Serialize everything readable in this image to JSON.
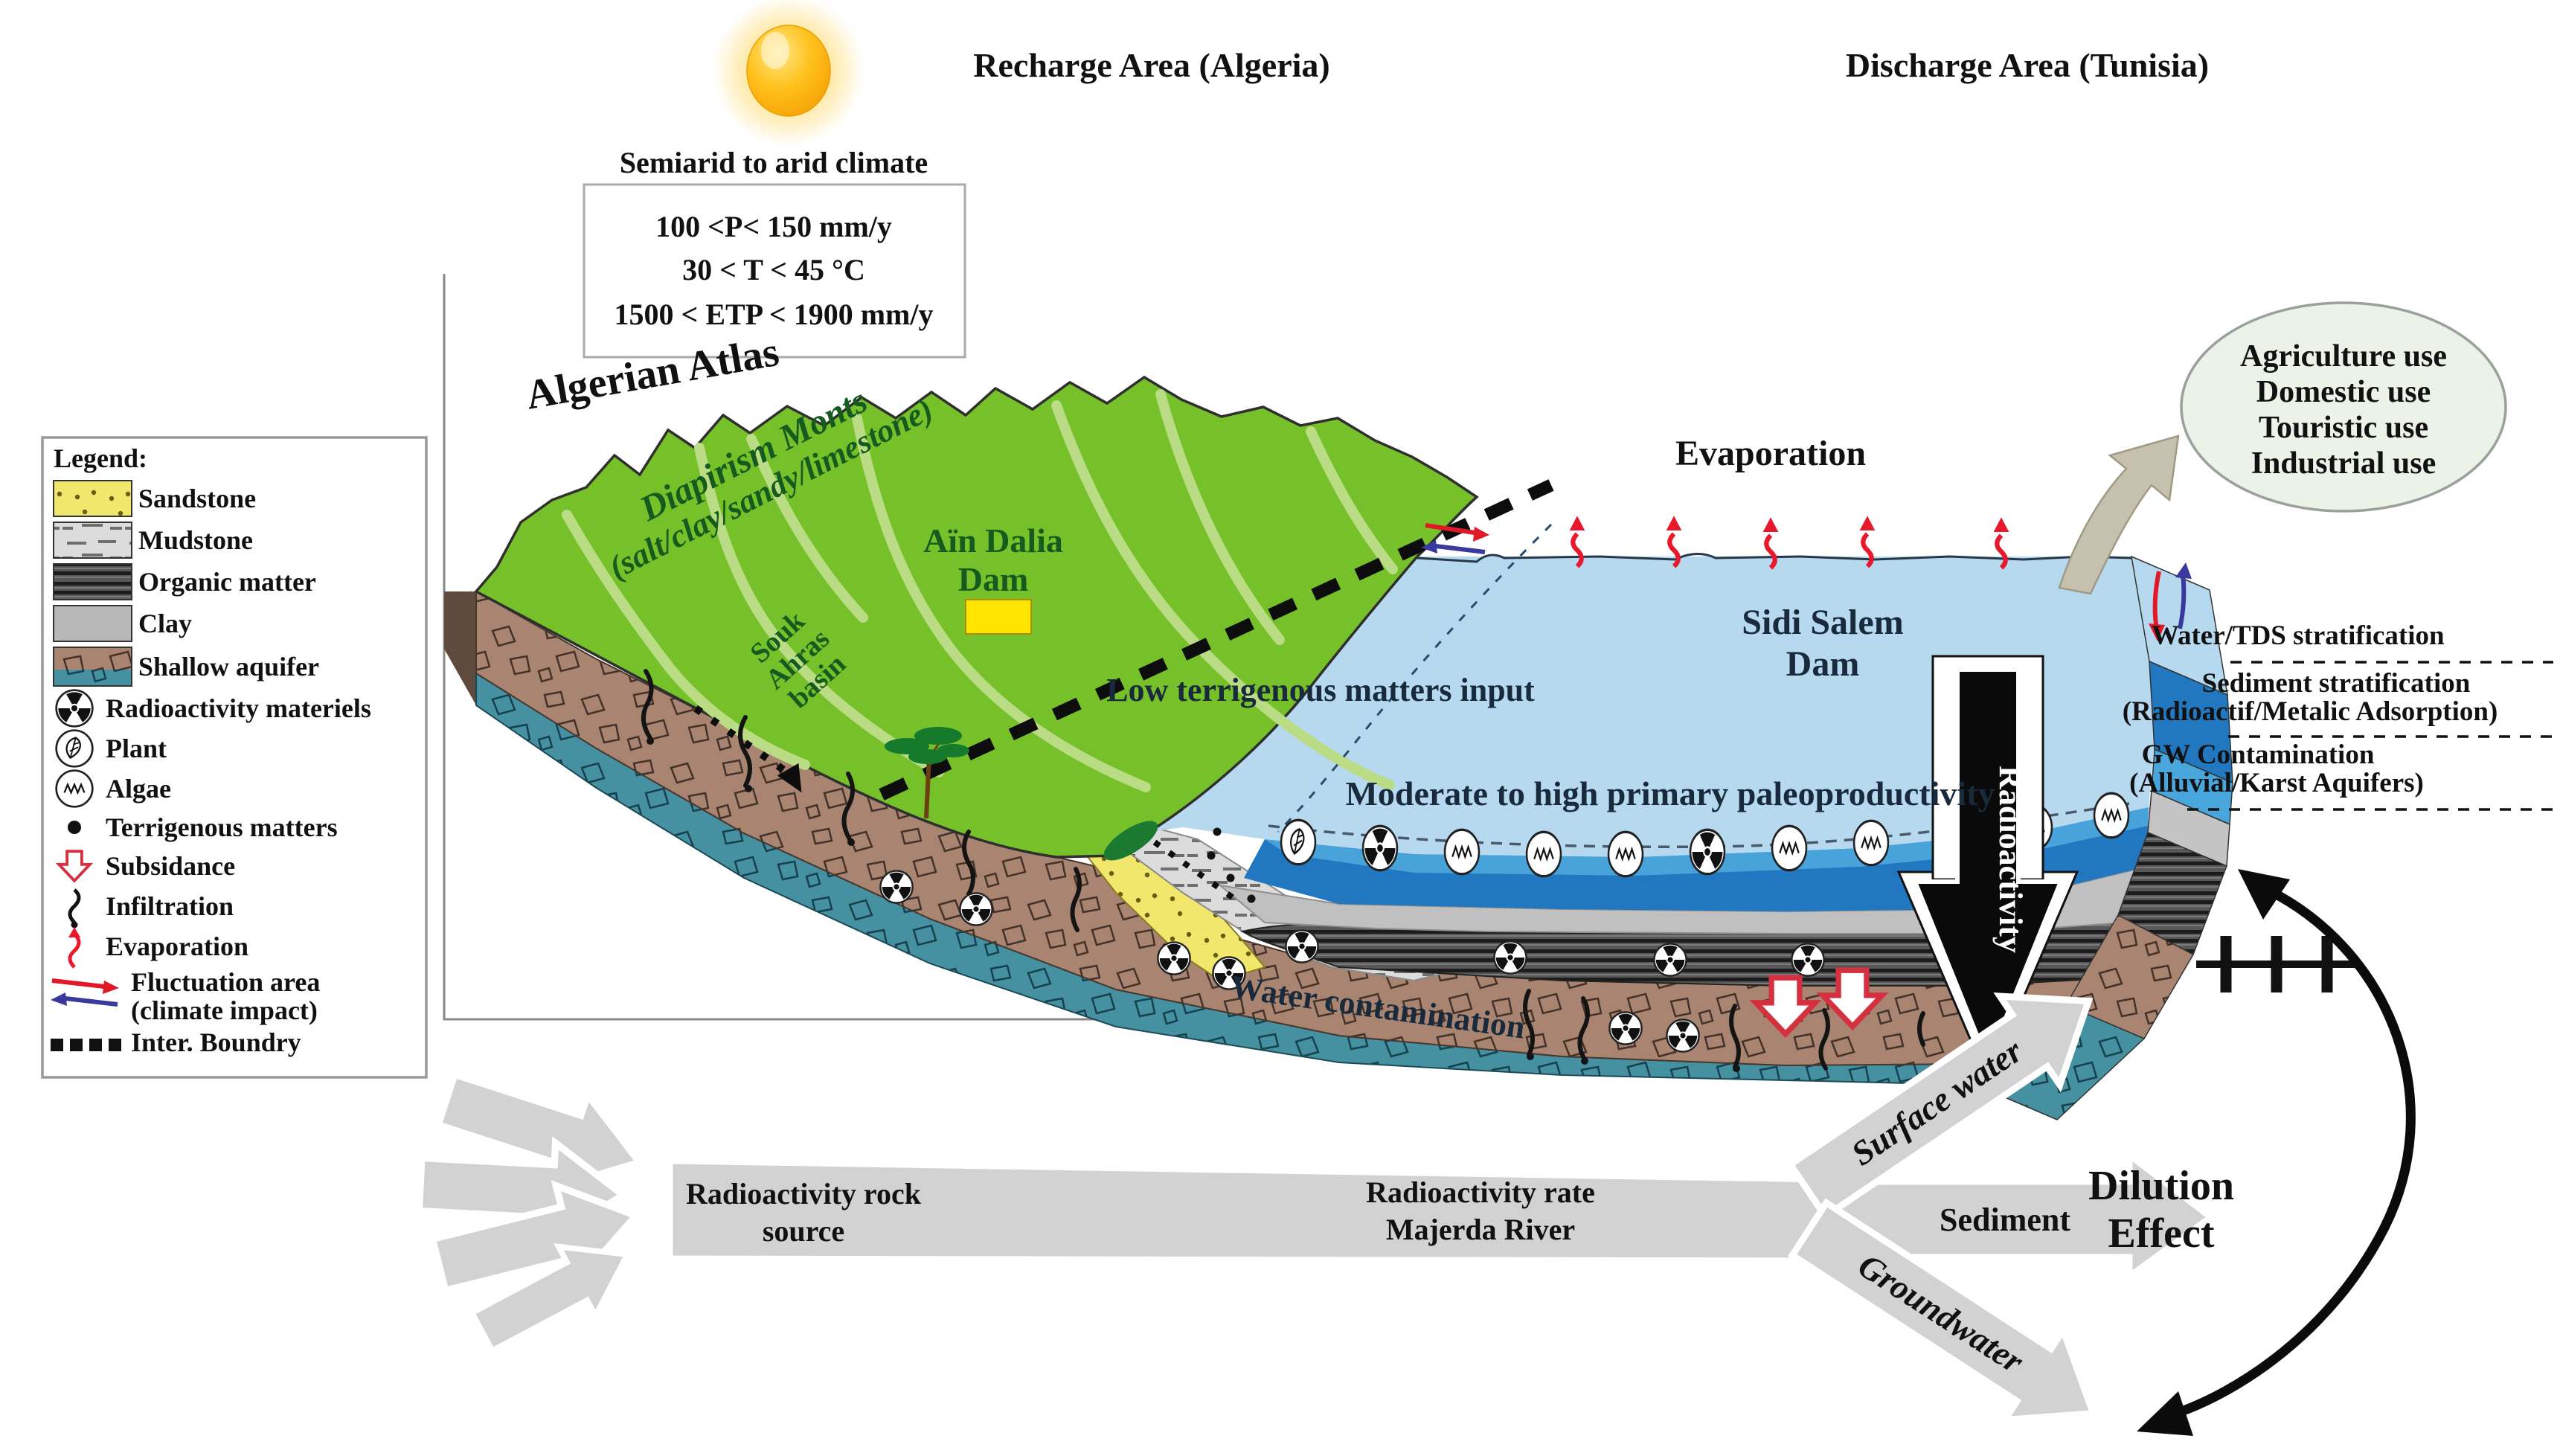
{
  "titles": {
    "recharge": "Recharge Area (Algeria)",
    "discharge": "Discharge Area (Tunisia)"
  },
  "climate": {
    "title": "Semiarid to arid climate",
    "lines": [
      "100 <P< 150 mm/y",
      "30 < T < 45 °C",
      "1500 < ETP < 1900 mm/y"
    ]
  },
  "legend": {
    "title": "Legend:",
    "items": [
      {
        "label": "Sandstone"
      },
      {
        "label": "Mudstone"
      },
      {
        "label": "Organic matter"
      },
      {
        "label": "Clay"
      },
      {
        "label": "Shallow aquifer"
      },
      {
        "label": "Radioactivity materiels"
      },
      {
        "label": "Plant"
      },
      {
        "label": "Algae"
      },
      {
        "label": "Terrigenous matters"
      },
      {
        "label": "Subsidance"
      },
      {
        "label": "Infiltration"
      },
      {
        "label": "Evaporation"
      },
      {
        "label": "Fluctuation area",
        "sublabel": "(climate impact)"
      },
      {
        "label": "Inter. Boundry"
      }
    ]
  },
  "map": {
    "algerian_atlas": "Algerian Atlas",
    "diapirism_line1": "Diapirism Monts",
    "diapirism_line2": "(salt/clay/sandy/limestone)",
    "ain_dalia_line1": "Aïn Dalia",
    "ain_dalia_line2": "Dam",
    "souk_line1": "Souk",
    "souk_line2": "Ahras",
    "souk_line3": "basin",
    "low_terrigenous": "Low terrigenous matters input",
    "paleoproductivity": "Moderate to high primary paleoproductivity",
    "evaporation": "Evaporation",
    "sidi_salem_line1": "Sidi Salem",
    "sidi_salem_line2": "Dam",
    "water_contamination": "Water contamination",
    "radioactivity_arrow": "Radioactivity"
  },
  "water_uses": {
    "lines": [
      "Agriculture use",
      "Domestic use",
      "Touristic use",
      "Industrial use"
    ]
  },
  "stratification": {
    "water_tds": "Water/TDS stratification",
    "sediment_line1": "Sediment stratification",
    "sediment_line2": "(Radioactif/Metalic Adsorption)",
    "gw_line1": "GW Contamination",
    "gw_line2": "(Alluvial/Karst Aquifers)"
  },
  "flow": {
    "rock_source_line1": "Radioactivity rock",
    "rock_source_line2": "source",
    "rate_line1": "Radioactivity rate",
    "rate_line2": "Majerda River",
    "surface_water": "Surface water",
    "sediment": "Sediment",
    "groundwater": "Groundwater",
    "dilution_line1": "Dilution",
    "dilution_line2": "Effect"
  },
  "colors": {
    "mountain_green": "#76c02a",
    "river_green": "#b9dc85",
    "lake_blue": "#b6d9ef",
    "deep_blue": "#2178c0",
    "clay_gray": "#c0c0c0",
    "organic_gray": "#575757",
    "aquifer_brown": "#a88471",
    "aquifer_teal": "#4591a2",
    "sandstone_yellow": "#f1e76d",
    "dam_yellow": "#ffe400",
    "evaporation_red": "#e8192c",
    "label_green": "#155a1e"
  }
}
